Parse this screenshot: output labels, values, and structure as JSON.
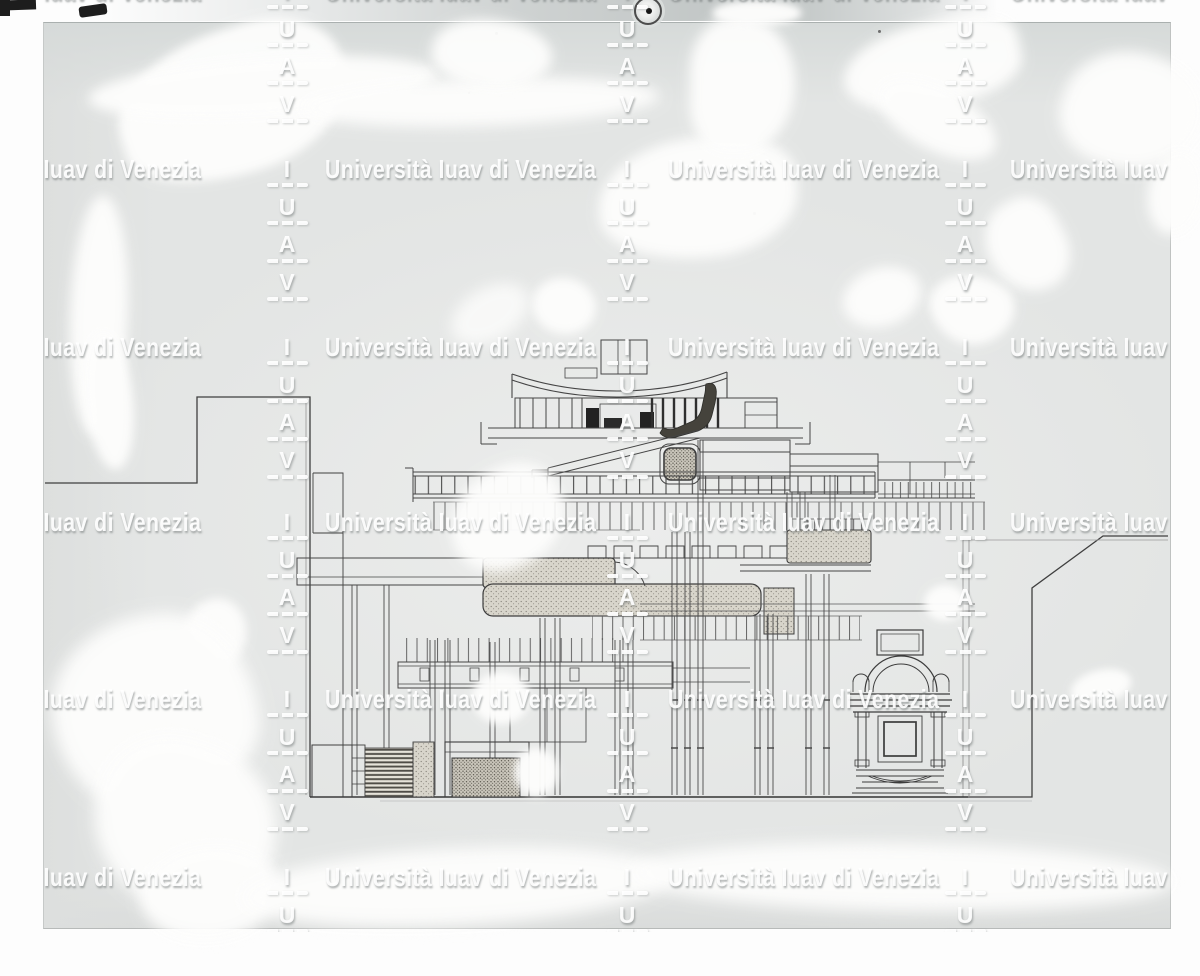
{
  "watermark": {
    "text": "Università Iuav di Venezia",
    "letters": [
      "I",
      "U",
      "A",
      "V"
    ],
    "rows_y": [
      -8,
      170,
      348,
      523,
      700,
      878
    ],
    "text_columns_x": [
      -70,
      325,
      668,
      1010
    ],
    "stack_columns_x": [
      287,
      627,
      965
    ],
    "letter_dy": [
      0,
      37.5,
      75,
      112.5
    ],
    "dash_dy": [
      15,
      53,
      91,
      129
    ],
    "color": "#ffffff",
    "shadow_color": "rgba(104,110,110,0.5)"
  },
  "colors": {
    "page": "#ffffff",
    "plate_gray": "#e3e5e4",
    "ink": "#454545",
    "retouch_paint": "#fdfdfc",
    "stipple_fill": "#d8d5cb",
    "dark_fill": "#45433c"
  }
}
